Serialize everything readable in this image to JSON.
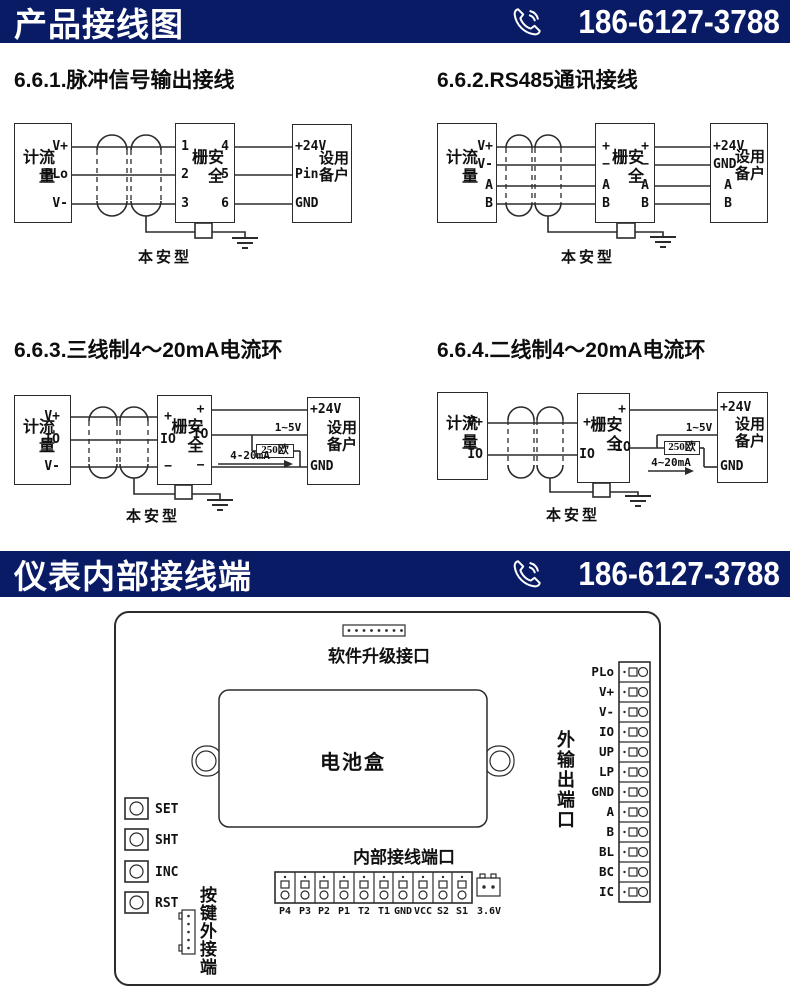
{
  "colors": {
    "banner_bg": "#0a1b66",
    "line": "#2b2b2b",
    "text": "#111111"
  },
  "banner1": {
    "title": "产品接线图",
    "phone": "186-6127-3788"
  },
  "banner2": {
    "title": "仪表内部接线端",
    "phone": "186-6127-3788"
  },
  "diagrams": {
    "d1": {
      "heading": "6.6.1.脉冲信号输出接线",
      "flowmeter": "流量计",
      "flow_terminals": [
        "V+",
        "PLo",
        "V-"
      ],
      "barrier": "安全栅",
      "barrier_left": [
        "1",
        "2",
        "3"
      ],
      "barrier_right": [
        "4",
        "5",
        "6"
      ],
      "device": "用户设备",
      "device_terminals": [
        "+24V",
        "Pin",
        "GND"
      ],
      "safe_label": "本安型"
    },
    "d2": {
      "heading": "6.6.2.RS485通讯接线",
      "flowmeter": "流量计",
      "flow_terminals": [
        "V+",
        "V-",
        "A",
        "B"
      ],
      "barrier": "安全栅",
      "barrier_left": [
        "+",
        "−",
        "A",
        "B"
      ],
      "barrier_right": [
        "+",
        "−",
        "A",
        "B"
      ],
      "device": "用户设备",
      "device_terminals": [
        "+24V",
        "GND",
        "A",
        "B"
      ],
      "safe_label": "本安型"
    },
    "d3": {
      "heading": "6.6.3.三线制4～20mA电流环",
      "flowmeter": "流量计",
      "flow_terminals": [
        "V+",
        "IO",
        "V-"
      ],
      "barrier": "安全栅",
      "barrier_left": [
        "+",
        "IO",
        "−"
      ],
      "barrier_right": [
        "+",
        "IO",
        "−"
      ],
      "device": "用户设备",
      "device_terminals": [
        "+24V",
        "GND"
      ],
      "volt_label": "1~5V",
      "resistor_label": "250欧",
      "current_label": "4-20mA",
      "safe_label": "本安型"
    },
    "d4": {
      "heading": "6.6.4.二线制4～20mA电流环",
      "flowmeter": "流量计",
      "flow_terminals": [
        "V+",
        "IO"
      ],
      "barrier": "安全栅",
      "barrier_left": [
        "+",
        "IO"
      ],
      "barrier_right": [
        "+",
        "IO"
      ],
      "device": "用户设备",
      "device_terminals": [
        "+24V",
        "GND"
      ],
      "volt_label": "1~5V",
      "resistor_label": "250欧",
      "current_label": "4~20mA",
      "safe_label": "本安型"
    }
  },
  "board": {
    "upgrade_port_label": "软件升级接口",
    "battery_label": "电池盒",
    "buttons": [
      "SET",
      "SHT",
      "INC",
      "RST"
    ],
    "keypad_label": "按键外接端",
    "internal_port_label": "内部接线端口",
    "internal_terminals": [
      "P4",
      "P3",
      "P2",
      "P1",
      "T2",
      "T1",
      "GND",
      "VCC",
      "S2",
      "S1"
    ],
    "battery_conn_label": "3.6V",
    "output_port_label": "外输出端口",
    "output_terminals": [
      "PLo",
      "V+",
      "V-",
      "IO",
      "UP",
      "LP",
      "GND",
      "A",
      "B",
      "BL",
      "BC",
      "IC"
    ]
  }
}
